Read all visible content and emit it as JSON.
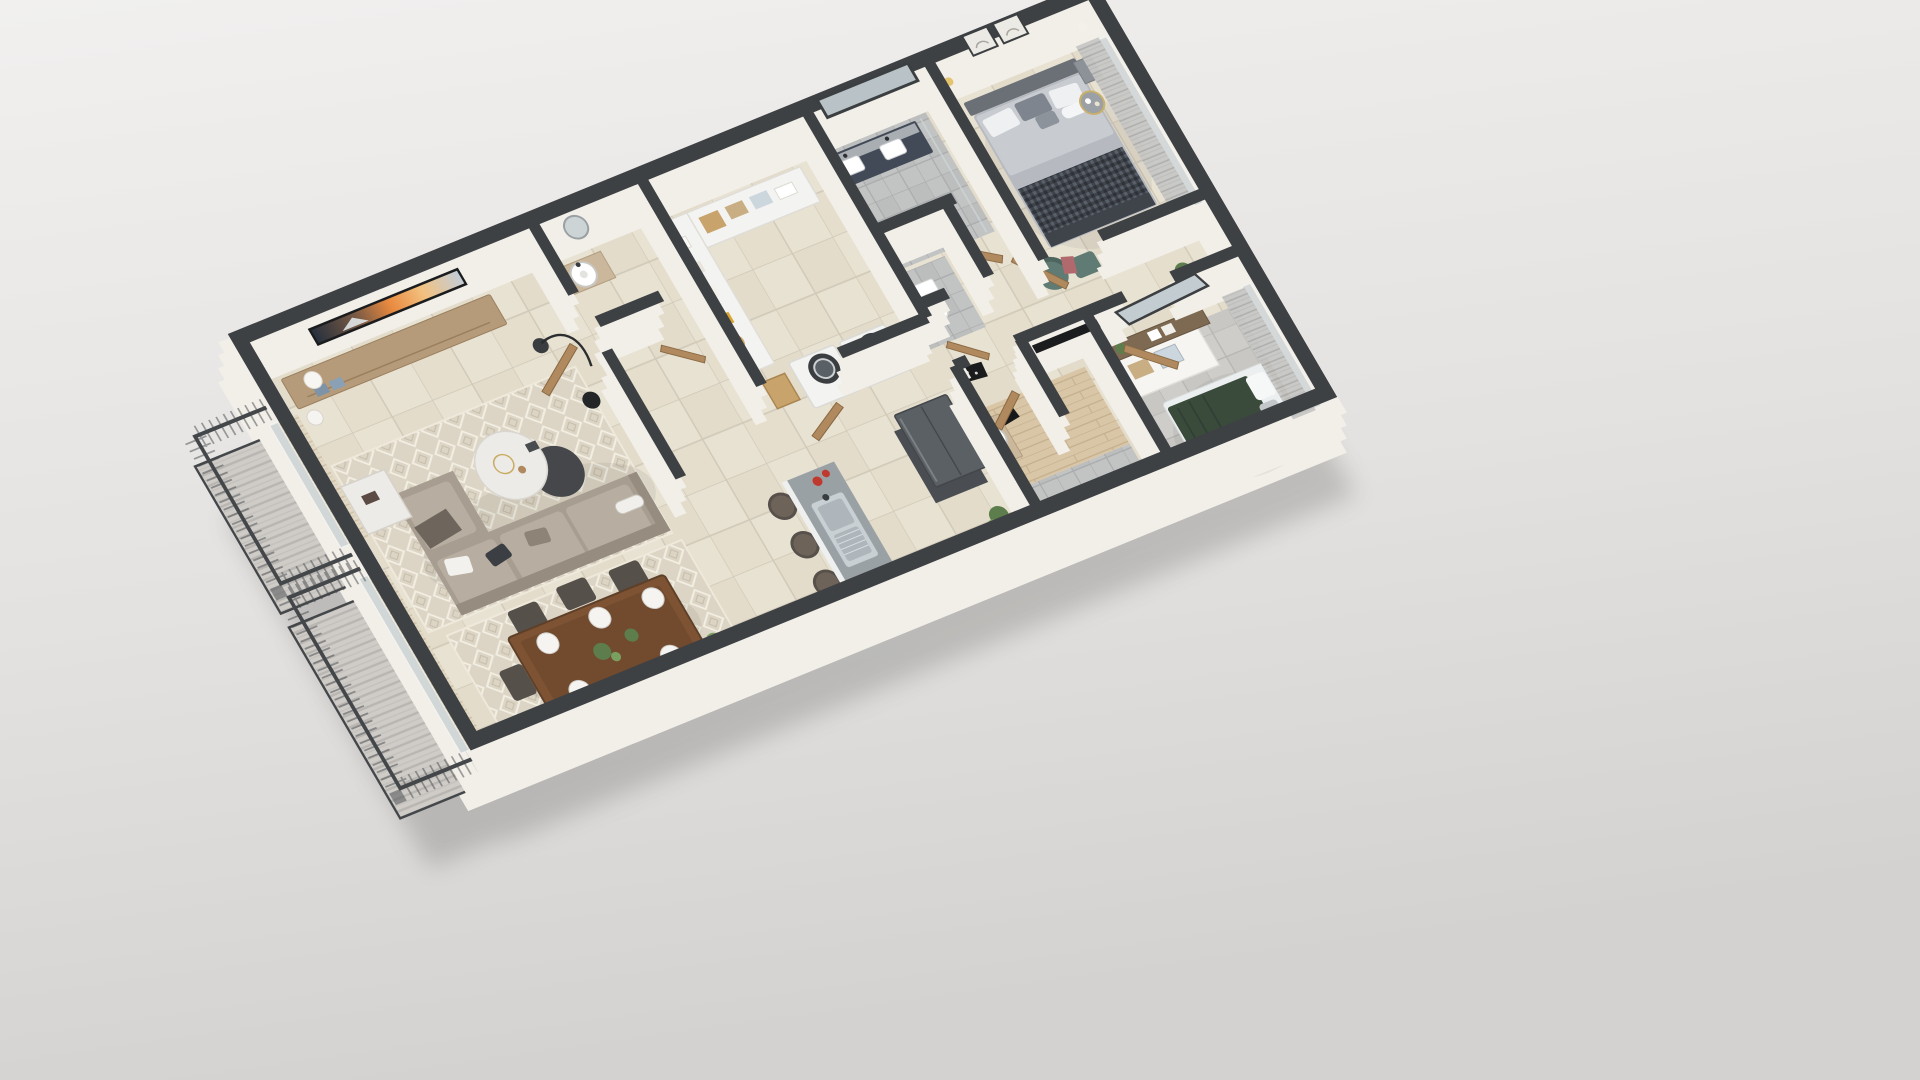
{
  "scene": {
    "type": "3d-floor-plan-render",
    "view": "axonometric top-down, rotated clockwise",
    "description": "Photorealistic 3D cutaway floor plan of a two-bedroom apartment with two bathrooms, open kitchen, laundry closet and side balcony on a light gray studio background"
  },
  "palette": {
    "background_top": "#f0efee",
    "background_bottom": "#d7d5d3",
    "wall_top": "#3e4144",
    "wall_face": "#f2efe9",
    "floor_tile": "#e8e2d3",
    "tile_grout": "#d2cab9",
    "bathroom_tile": "#c2c4c4",
    "bedroom2_tile": "#cecdc9",
    "wood_floor": "#d9c6a7",
    "door_wood": "#b08a5e",
    "rug": "#dcd5c5",
    "sofa": "#a79d90",
    "sofa_cushion": "#b7ada0",
    "coffee_table_dark": "#45474a",
    "marble": "#ecebe7",
    "dining_table": "#7d5333",
    "chair_dark": "#55504a",
    "bench_yellow": "#d9b64d",
    "counter_gray": "#9aa1a5",
    "cooktop_black": "#141617",
    "fridge_gray": "#5b6064",
    "steel": "#c9d0d4",
    "appliance_white": "#f3f3f1",
    "vanity_navy": "#434a57",
    "mirror_glass": "#b9c3c7",
    "bed_mattress": "#b6bac0",
    "headboard": "#6b7077",
    "throw_dark": "#3f444b",
    "green_blanket": "#3a4b3c",
    "accent_chair": "#5f7b73",
    "accent_pink": "#b06a6d",
    "plant_green": "#5d7d4c",
    "lamp_gold": "#e3c46c",
    "tv_frame": "#1b1c1e",
    "tv_screen_warm": "#e0763a",
    "curtain_gray": "#c6c6c4",
    "curtain_tan": "#e2d8c3",
    "railing_dark": "#44474a",
    "shadow": "#3c3c3a"
  },
  "rooms": [
    {
      "id": "living-room",
      "furniture": [
        "tv-media-console",
        "flat-screen-tv",
        "table-lamp",
        "l-shaped-sofa",
        "marble-side-table",
        "round-coffee-tables",
        "arc-floor-lamp",
        "diamond-pattern-rug",
        "balcony-windows-with-blinds"
      ]
    },
    {
      "id": "dining-area",
      "furniture": [
        "wood-dining-table",
        "dark-dining-chairs",
        "place-settings",
        "potted-plants",
        "diamond-pattern-rug",
        "yellow-bench",
        "decor-spheres"
      ]
    },
    {
      "id": "kitchen",
      "furniture": [
        "l-shaped-counter",
        "double-steel-sink",
        "induction-cooktop",
        "refrigerator",
        "bar-stools",
        "red-cookware",
        "counter-plant"
      ]
    },
    {
      "id": "laundry-closet",
      "furniture": [
        "washer",
        "dryer",
        "linen-shelves",
        "towels",
        "baskets",
        "sun-hats",
        "folded-clothes"
      ]
    },
    {
      "id": "powder-room",
      "furniture": [
        "round-vessel-sink",
        "vanity",
        "round-mirror"
      ]
    },
    {
      "id": "master-bathroom",
      "furniture": [
        "navy-double-vanity",
        "twin-sinks",
        "framed-wall-mirror",
        "water-closet-toilet"
      ]
    },
    {
      "id": "master-bedroom",
      "furniture": [
        "upholstered-bed",
        "houndstooth-throw",
        "pillows",
        "two-nightstands",
        "wall-art-frames",
        "accent-armchair",
        "ottoman",
        "gold-side-table",
        "curtained-sliding-door"
      ]
    },
    {
      "id": "hallway",
      "furniture": [
        "open-wood-doors",
        "door-mat"
      ]
    },
    {
      "id": "second-bathroom",
      "furniture": [
        "vessel-sink-vanity",
        "toilet",
        "second-vessel-sink",
        "wood-plank-floor"
      ]
    },
    {
      "id": "second-bedroom",
      "furniture": [
        "green-blanket-bed",
        "white-clothes-table",
        "dresser-with-leaning-mirror",
        "plants",
        "wall-tv-panel",
        "gold-table-lamp",
        "curtained-window"
      ]
    },
    {
      "id": "balcony",
      "furniture": [
        "metal-railing",
        "striped-decking"
      ]
    }
  ]
}
